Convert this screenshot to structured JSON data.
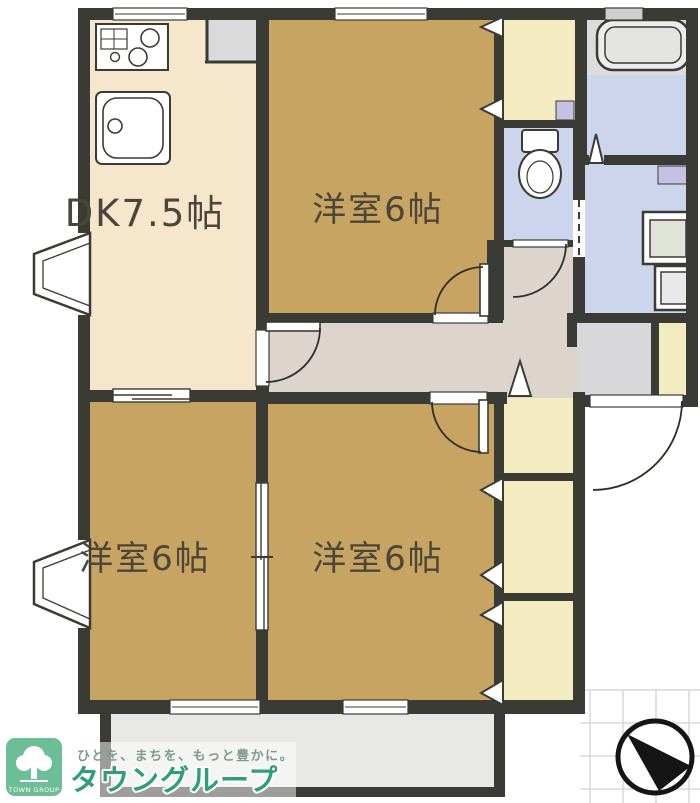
{
  "plan": {
    "rooms": {
      "dk": {
        "label": "DK7.5帖"
      },
      "bedroom_top": {
        "label": "洋室6帖"
      },
      "bedroom_bottom_left": {
        "label": "洋室6帖"
      },
      "bedroom_bottom_right": {
        "label": "洋室6帖"
      }
    },
    "fixtures": [
      "gas-stove",
      "kitchen-sink",
      "refrigerator-space",
      "bathtub",
      "toilet",
      "washing-machine",
      "washbasin",
      "vanity",
      "bay-window",
      "bay-window",
      "closet",
      "closet",
      "closet",
      "closet",
      "shoe-cabinet",
      "balcony",
      "entrance"
    ]
  },
  "branding": {
    "tagline": "ひとを、まちを、もっと豊かに。",
    "company": "タウングループ",
    "logo_caption": "TOWN GROUP"
  },
  "compass": {
    "type": "north-arrow"
  },
  "colors": {
    "wall": "#3b3b35",
    "dk_floor": "#f6e7cc",
    "bedroom_floor": "#c8a463",
    "hallway_floor": "#ddd5cd",
    "wet_area_floor": "#ccd5ec",
    "closet_fill": "#f3ecc0",
    "accent_purple": "#c5c1e4",
    "entrance_floor": "#d8d8da",
    "balcony_floor": "#e8e8e6",
    "brand_green": "#2f9e7a",
    "logo_green": "#6cbe98"
  }
}
